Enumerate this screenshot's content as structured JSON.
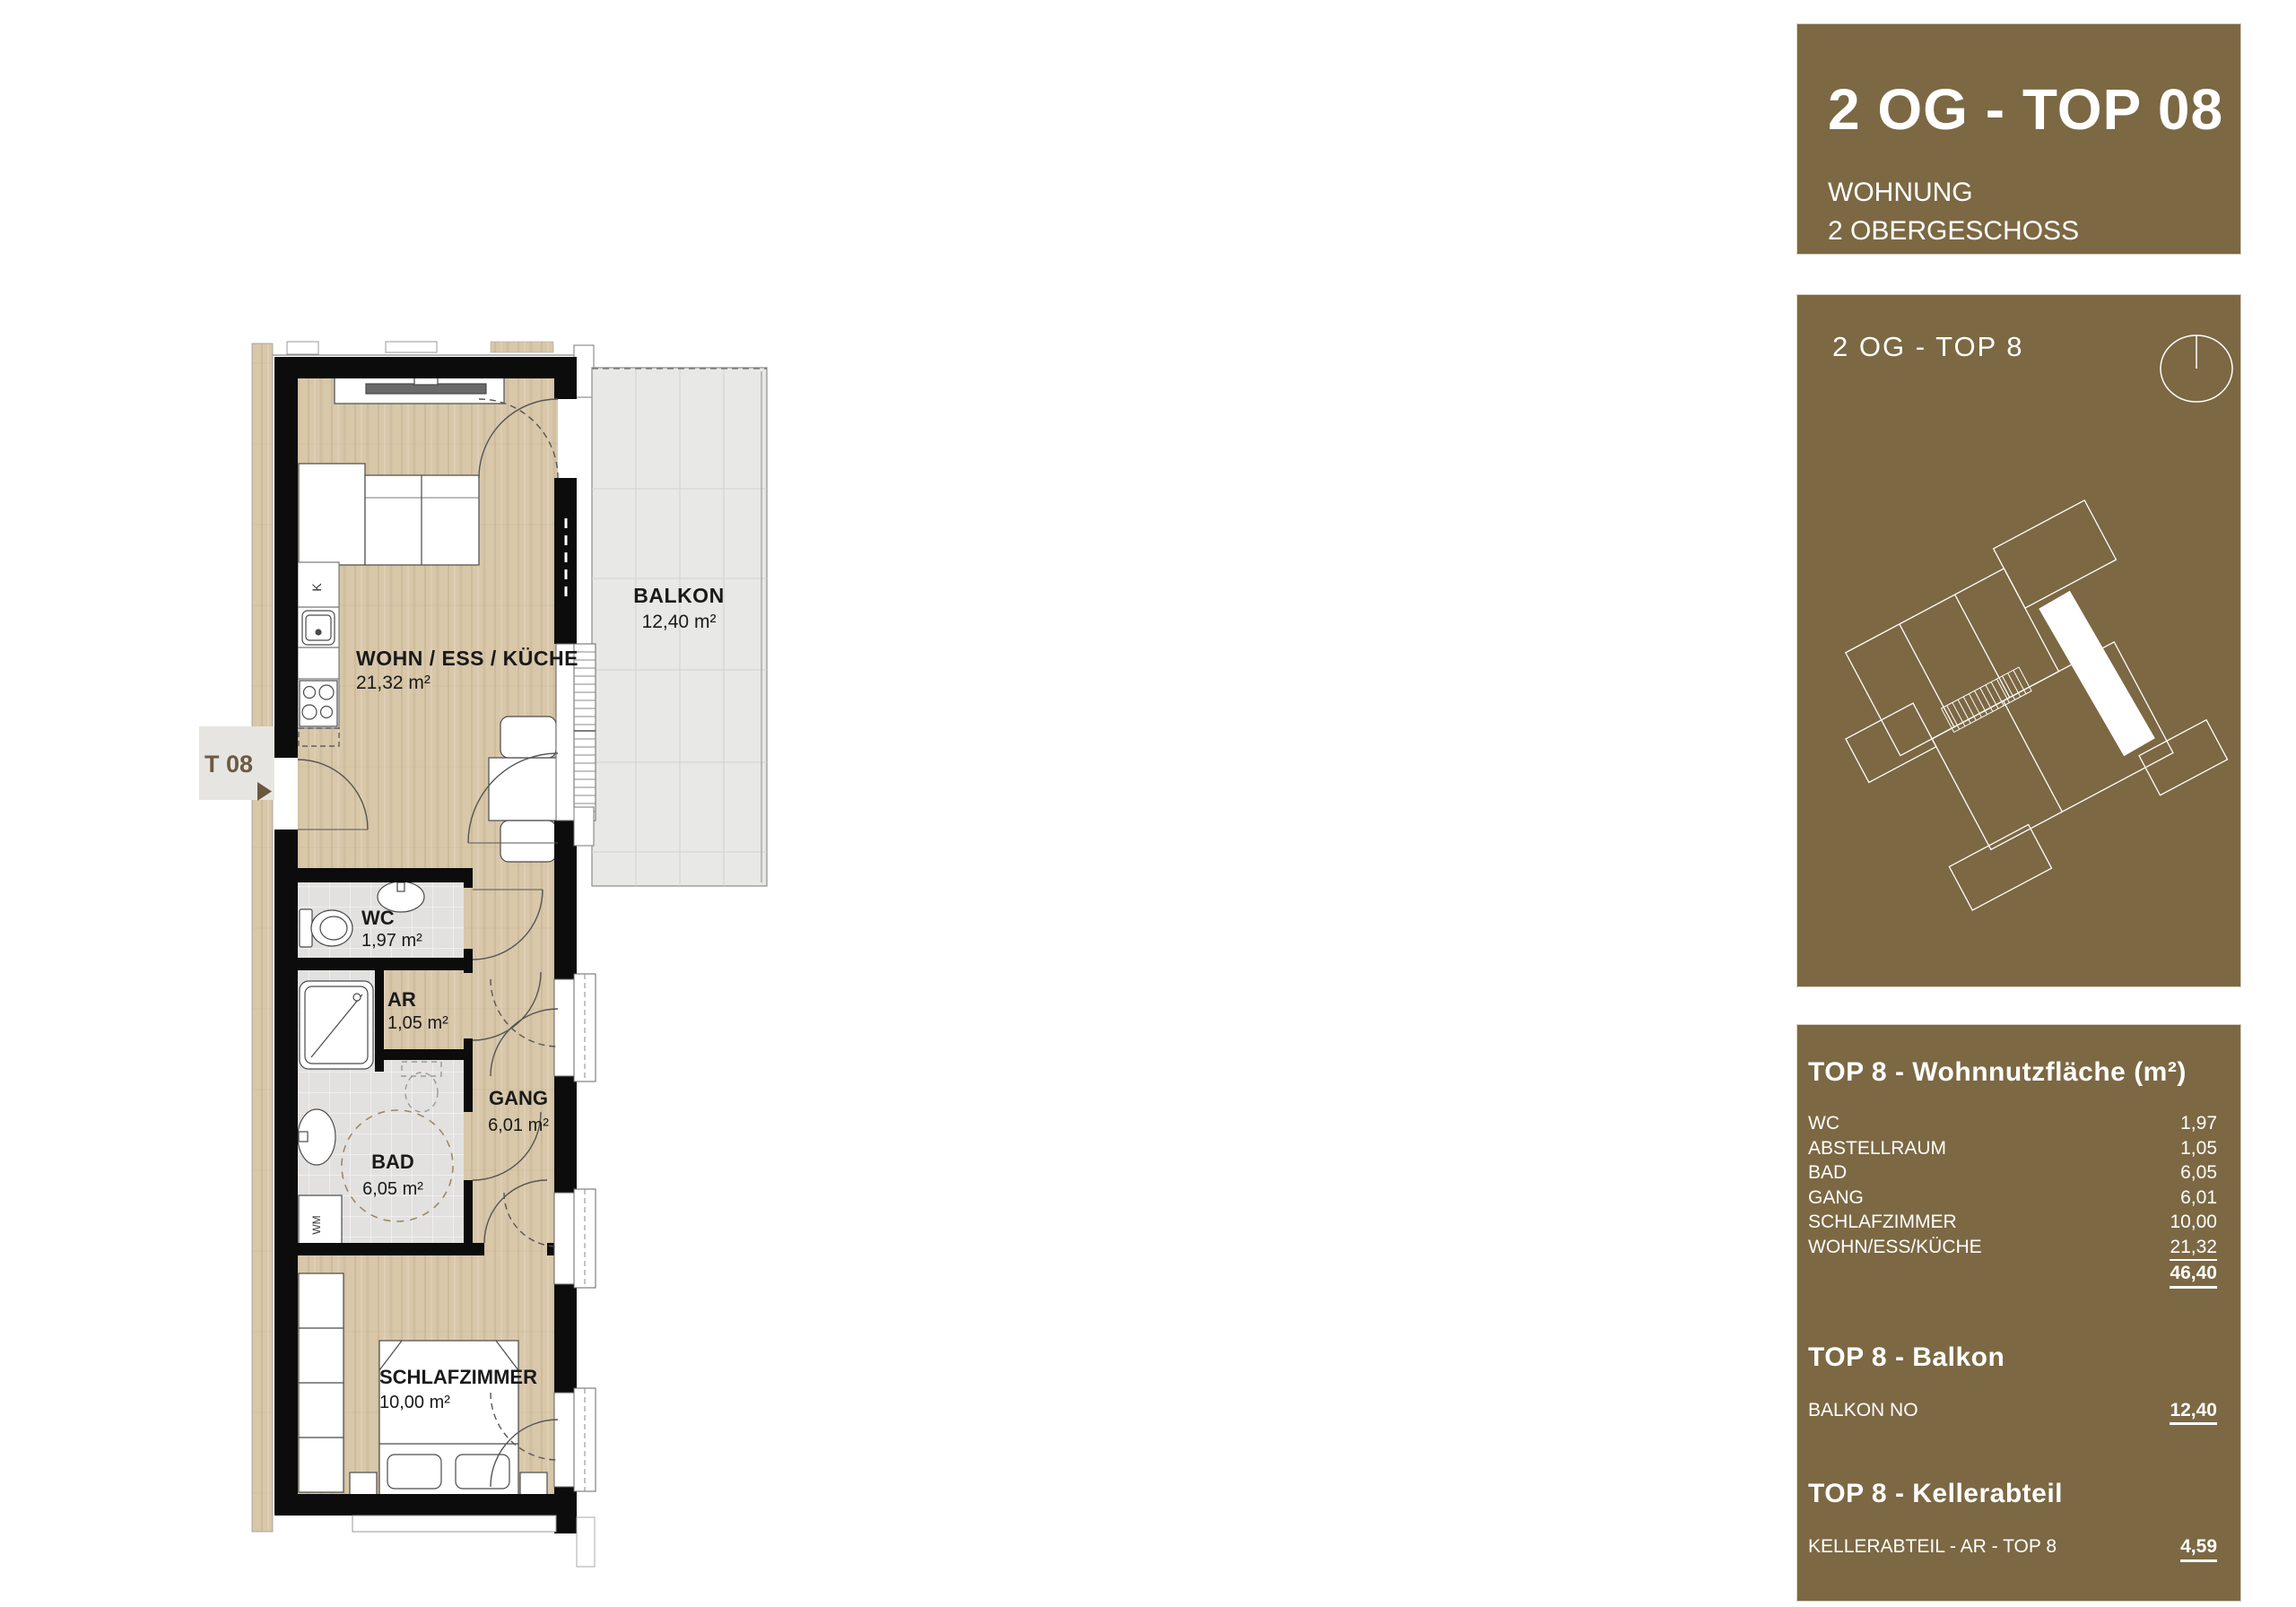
{
  "header": {
    "title": "2 OG - TOP 08",
    "subtitle_1": "WOHNUNG",
    "subtitle_2": "2 OBERGESCHOSS"
  },
  "siteplan": {
    "title": "2 OG - TOP 8",
    "compass_icon": "north-compass-icon"
  },
  "table": {
    "heading": "TOP 8 - Wohnnutzfläche (m²)",
    "rows": [
      {
        "label": "WC",
        "value": "1,97"
      },
      {
        "label": "ABSTELLRAUM",
        "value": "1,05"
      },
      {
        "label": "BAD",
        "value": "6,05"
      },
      {
        "label": "GANG",
        "value": "6,01"
      },
      {
        "label": "SCHLAFZIMMER",
        "value": "10,00"
      },
      {
        "label": "WOHN/ESS/KÜCHE",
        "value": "21,32"
      }
    ],
    "total": "46,40",
    "balkon_heading": "TOP 8 - Balkon",
    "balkon_row": {
      "label": "BALKON NO",
      "value": "12,40"
    },
    "keller_heading": "TOP 8 - Kellerabteil",
    "keller_row": {
      "label": "KELLERABTEIL - AR - TOP 8",
      "value": "4,59"
    }
  },
  "plan": {
    "entry_label": "T 08",
    "rooms": {
      "wohn": {
        "name": "WOHN / ESS / KÜCHE",
        "area": "21,32 m²"
      },
      "balkon": {
        "name": "BALKON",
        "area": "12,40 m²"
      },
      "wc": {
        "name": "WC",
        "area": "1,97 m²"
      },
      "ar": {
        "name": "AR",
        "area": "1,05 m²"
      },
      "gang": {
        "name": "GANG",
        "area": "6,01 m²"
      },
      "bad": {
        "name": "BAD",
        "area": "6,05 m²"
      },
      "schlafzimmer": {
        "name": "SCHLAFZIMMER",
        "area": "10,00 m²"
      }
    },
    "fixtures": {
      "kitchen_unit": "K",
      "washing_machine": "WM"
    }
  },
  "colors": {
    "brand_brown": "#7c6843",
    "label_brown": "#6d5a42",
    "arrow_brown": "#6b573b",
    "wall_black": "#0c0c0c",
    "wood": "#d8c7a9",
    "tile": "#e2e1e0",
    "balcony": "#e8e8e7",
    "corridor": "#e7e5e2",
    "text_dark": "#1a1a1a"
  }
}
